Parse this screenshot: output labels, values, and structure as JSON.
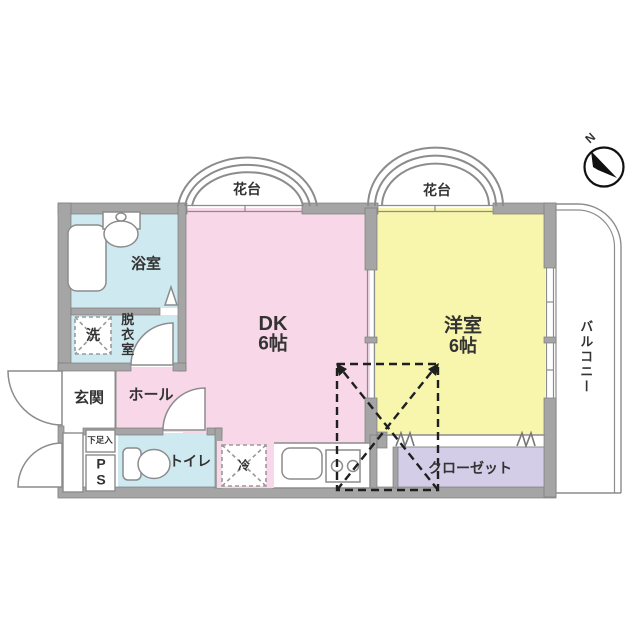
{
  "title": "1DK floor plan",
  "colors": {
    "dk_pink": "#f8d8e8",
    "room_yellow": "#f8f5ad",
    "wet_blue": "#cfe9f0",
    "closet_purple": "#d4cde7",
    "wall_gray": "#a5a5a5",
    "line_gray": "#8c8c8c",
    "dash_black": "#1f1f1f",
    "text": "#333333"
  },
  "compass": {
    "north_label": "N"
  },
  "rooms": {
    "flower_stand_left": {
      "label": "花台"
    },
    "flower_stand_right": {
      "label": "花台"
    },
    "dk": {
      "name": "DK",
      "size": "6帖"
    },
    "western_room": {
      "name": "洋室",
      "size": "6帖"
    },
    "bathroom": {
      "label": "浴室"
    },
    "dressing_room": {
      "label": "脱衣室"
    },
    "washer": {
      "label": "洗"
    },
    "entrance": {
      "label": "玄関"
    },
    "hall": {
      "label": "ホール"
    },
    "shoe_box": {
      "label": "下足入"
    },
    "pipe_space": {
      "label": "PS"
    },
    "toilet": {
      "label": "トイレ"
    },
    "refrigerator": {
      "label": "冷"
    },
    "closet": {
      "label": "クローゼット"
    },
    "balcony": {
      "label": "バルコニー"
    }
  }
}
